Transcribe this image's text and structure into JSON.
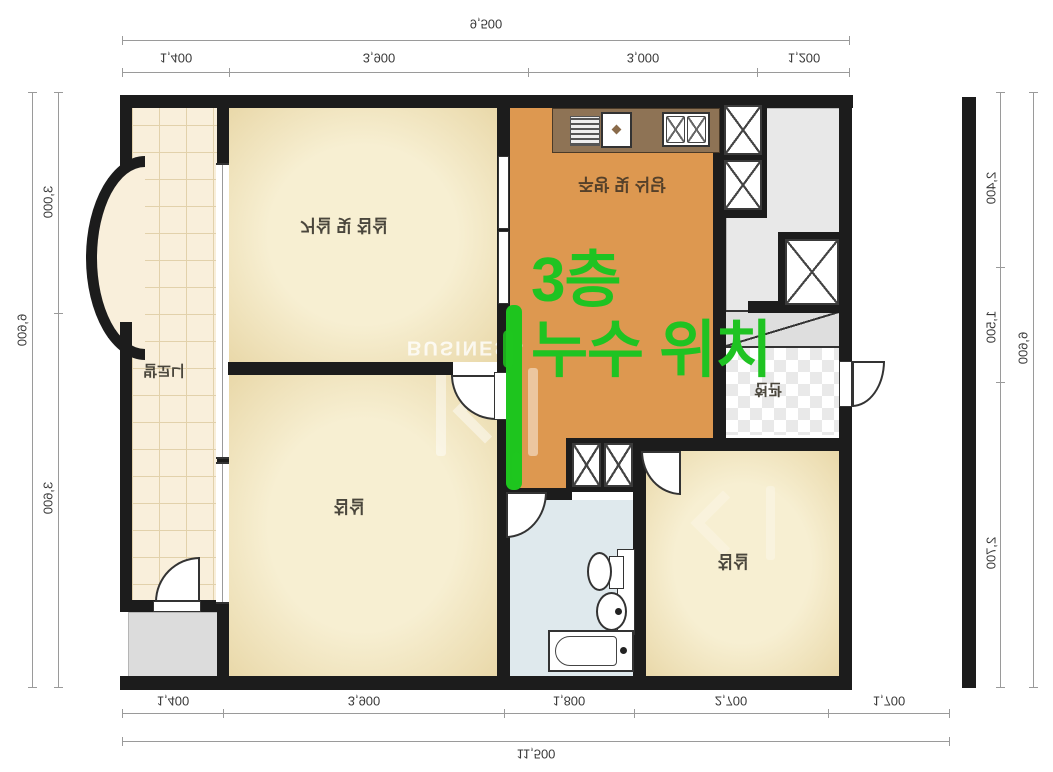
{
  "annotation": {
    "line1": "3층",
    "line2": "누수 위치",
    "color": "#1fc322"
  },
  "watermark": {
    "text": "BUSINESS"
  },
  "rooms": {
    "balcony": "발코니",
    "living": "거실 및 침실",
    "kitchen": "주방 및 식당",
    "bedroom_left": "침실",
    "bedroom_right": "침실",
    "entry": "현관"
  },
  "dimensions": {
    "top": {
      "total": "9,500",
      "segments": [
        "1,400",
        "3,900",
        "3,000",
        "1,200"
      ]
    },
    "bottom": {
      "total": "11,500",
      "segments": [
        "1,400",
        "3,900",
        "1,800",
        "2,700",
        "1,700"
      ]
    },
    "left": {
      "total": "6,600",
      "segments": [
        "3,000",
        "3,600"
      ]
    },
    "right": {
      "total": "6,600",
      "segments": [
        "2,400",
        "1,500",
        "2,700"
      ]
    }
  }
}
